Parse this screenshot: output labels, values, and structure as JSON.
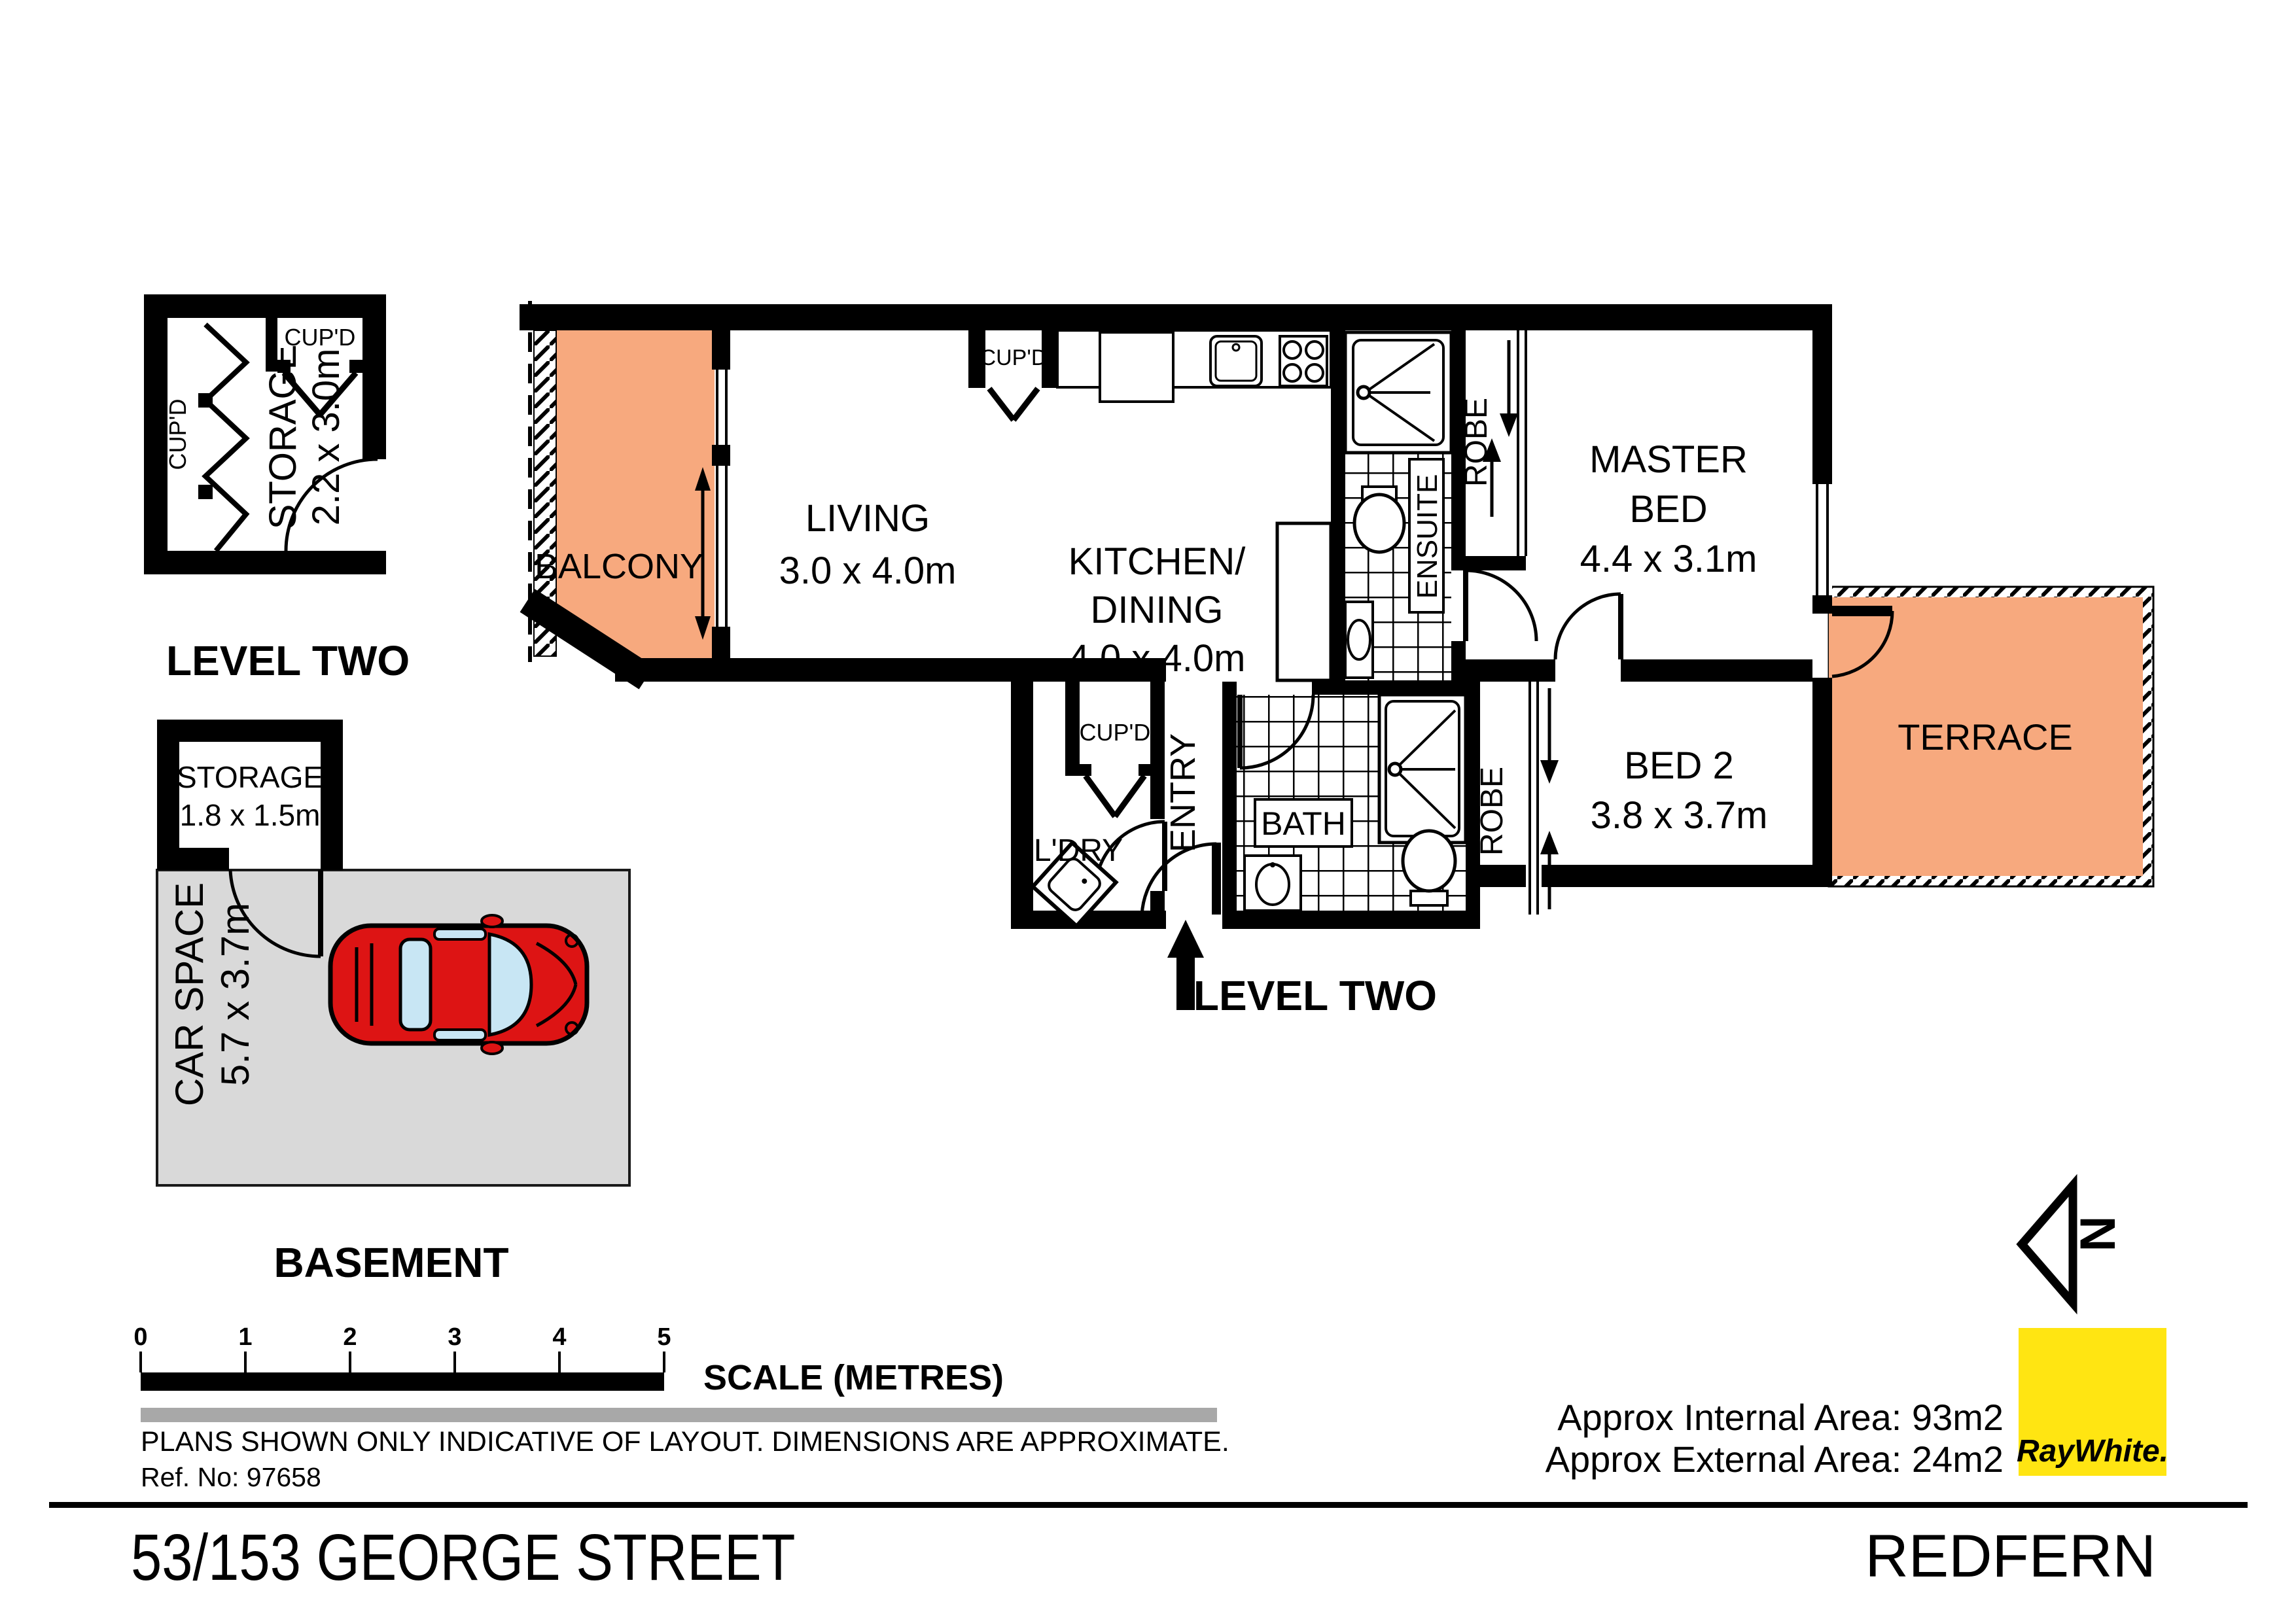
{
  "plans": {
    "storage_level_two": {
      "floor_label": "LEVEL TWO",
      "storage_name": "STORAGE",
      "storage_dims": "2.2 x 3.0m",
      "cupboard_left": "CUP'D",
      "cupboard_top": "CUP'D"
    },
    "basement": {
      "floor_label": "BASEMENT",
      "storage_name": "STORAGE",
      "storage_dims": "1.8 x 1.5m",
      "car_space_name": "CAR SPACE",
      "car_space_dims": "5.7 x 3.7m"
    },
    "apartment": {
      "floor_label": "LEVEL TWO",
      "balcony": "BALCONY",
      "living_name": "LIVING",
      "living_dims": "3.0 x 4.0m",
      "kitchen_line1": "KITCHEN/",
      "kitchen_line2": "DINING",
      "kitchen_dims": "4.0 x 4.0m",
      "kitchen_cupboard": "CUP'D",
      "ensuite": "ENSUITE",
      "master_robe": "ROBE",
      "master_line1": "MASTER",
      "master_line2": "BED",
      "master_dims": "4.4 x 3.1m",
      "terrace": "TERRACE",
      "entry": "ENTRY",
      "laundry": "L'DRY",
      "laundry_cupboard": "CUP'D",
      "bath": "BATH",
      "bed2_robe": "ROBE",
      "bed2_name": "BED 2",
      "bed2_dims": "3.8 x 3.7m"
    }
  },
  "compass": {
    "north_label": "N"
  },
  "scale_bar": {
    "ticks": [
      "0",
      "1",
      "2",
      "3",
      "4",
      "5"
    ],
    "caption": "SCALE (METRES)"
  },
  "notes": {
    "disclaimer": "PLANS SHOWN ONLY INDICATIVE OF LAYOUT.  DIMENSIONS ARE APPROXIMATE.",
    "reference": "Ref. No: 97658"
  },
  "areas": {
    "internal": "Approx Internal Area: 93m2",
    "external": "Approx External Area: 24m2"
  },
  "branding": {
    "agency_name": "RayWhite."
  },
  "footer": {
    "address": "53/153 GEORGE STREET",
    "suburb": "REDFERN"
  },
  "colors": {
    "outdoor_fill": "#F7A97E",
    "car_space_fill": "#D9D9D9",
    "car_body": "#DD1414",
    "car_glass": "#C8E6F4",
    "brand_yellow": "#FFE512",
    "brand_text": "#6D6E71",
    "gray_bar": "#A8A8A8",
    "wall": "#000000"
  }
}
